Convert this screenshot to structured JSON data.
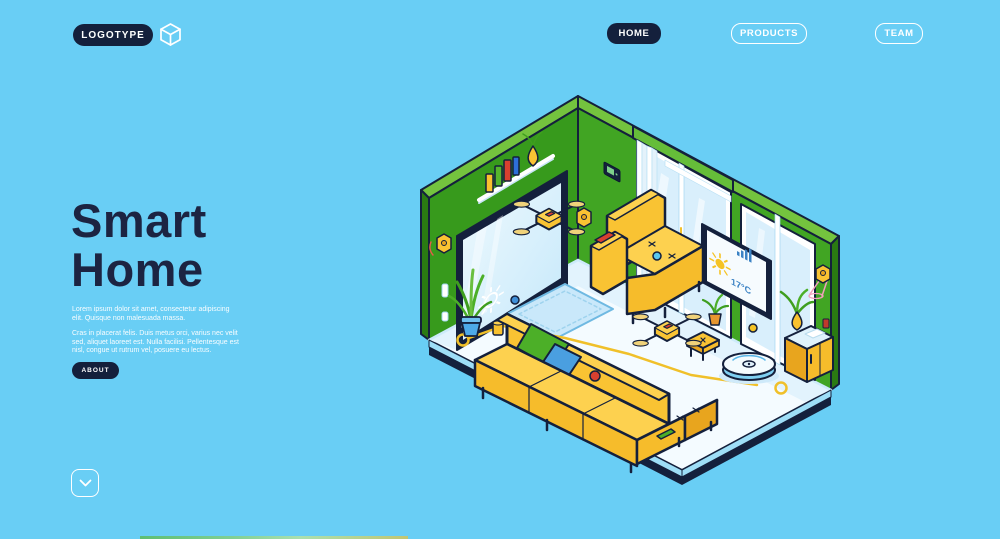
{
  "header": {
    "logo_label": "LOGOTYPE",
    "nav": {
      "home": "HOME",
      "products": "PRODUCTS",
      "team": "TEAM"
    }
  },
  "hero": {
    "title_line1": "Smart",
    "title_line2": "Home",
    "paragraph1": "Lorem ipsum dolor sit amet, consectetur adipiscing elit. Quisque non malesuada massa.",
    "paragraph2": "Cras in placerat felis. Duis metus orci, varius nec velit sed, aliquet laoreet est. Nulla facilisi. Pellentesque est nisl, congue ut rutrum vel, posuere eu lectus.",
    "about_label": "ABOUT"
  },
  "illustration": {
    "description": "isometric smart home living room",
    "panel_reading": "17°C"
  },
  "colors": {
    "background": "#69cef5",
    "navy": "#14203c",
    "wall_green": "#3e9f1f",
    "rim_green": "#74c33e",
    "accent_yellow": "#f9c333",
    "path_yellow": "#f0c02a",
    "white": "#ffffff"
  }
}
